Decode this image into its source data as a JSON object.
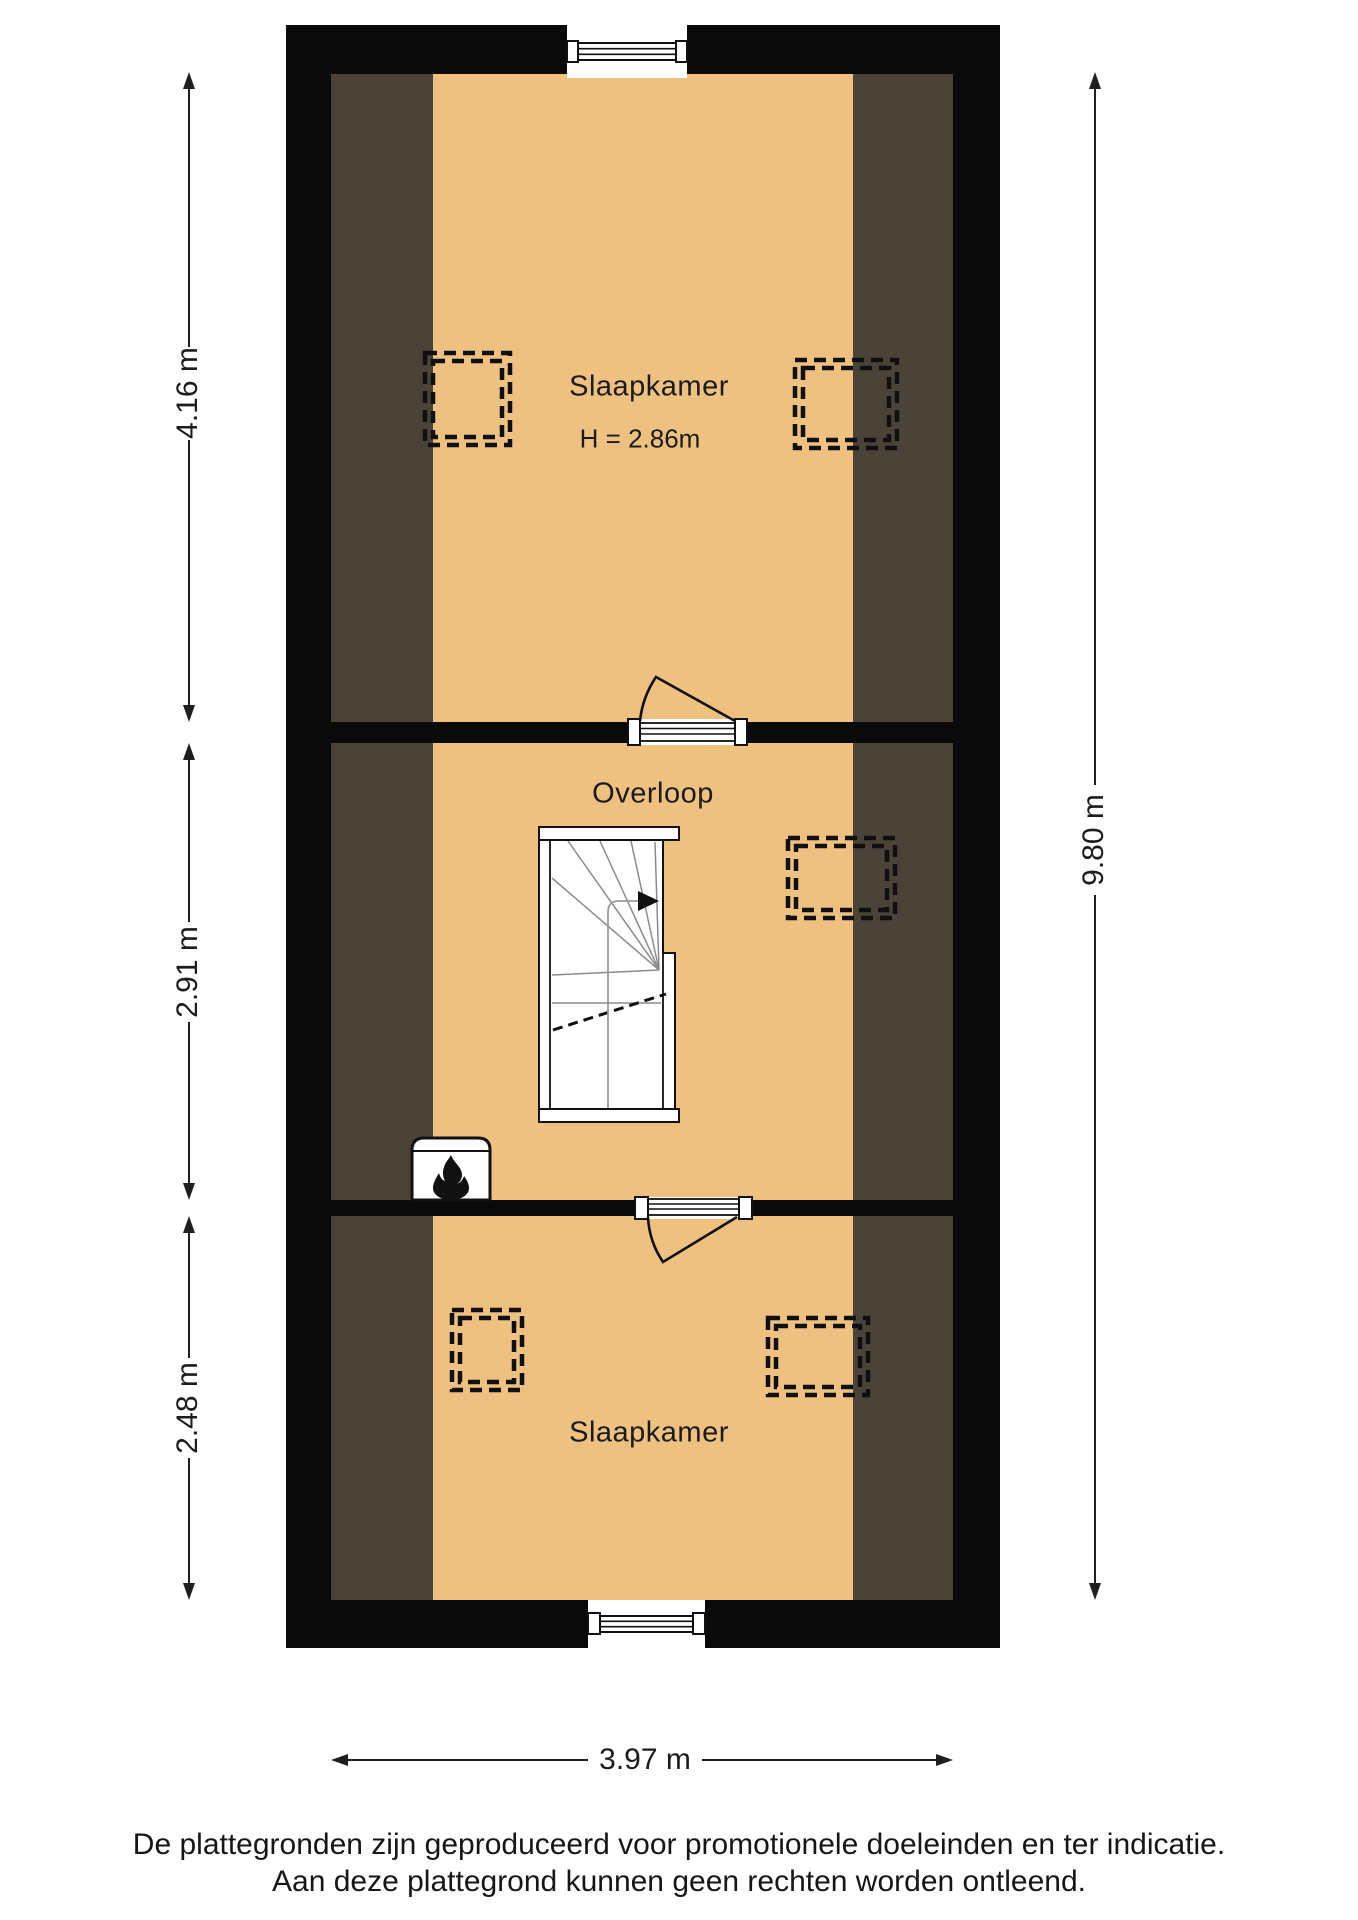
{
  "rooms": {
    "top_bedroom": {
      "label": "Slaapkamer",
      "ceiling_height": "H = 2.86m"
    },
    "landing": {
      "label": "Overloop"
    },
    "bottom_bedroom": {
      "label": "Slaapkamer"
    }
  },
  "dimensions": {
    "left_top": "4.16 m",
    "left_middle": "2.91 m",
    "left_bottom": "2.48 m",
    "right_total": "9.80 m",
    "bottom_width": "3.97 m"
  },
  "disclaimer": {
    "line1": "De plattegronden zijn geproduceerd voor promotionele doeleinden en ter indicatie.",
    "line2": "Aan deze plattegrond kunnen geen rechten worden ontleend."
  },
  "colors": {
    "floor": "#eec180",
    "sloped_ceiling": "#4a4337",
    "wall": "#0a0a0a",
    "background": "#ffffff"
  },
  "icons": {
    "stove": "fire-icon",
    "stair_direction": "arrow-right-icon"
  }
}
